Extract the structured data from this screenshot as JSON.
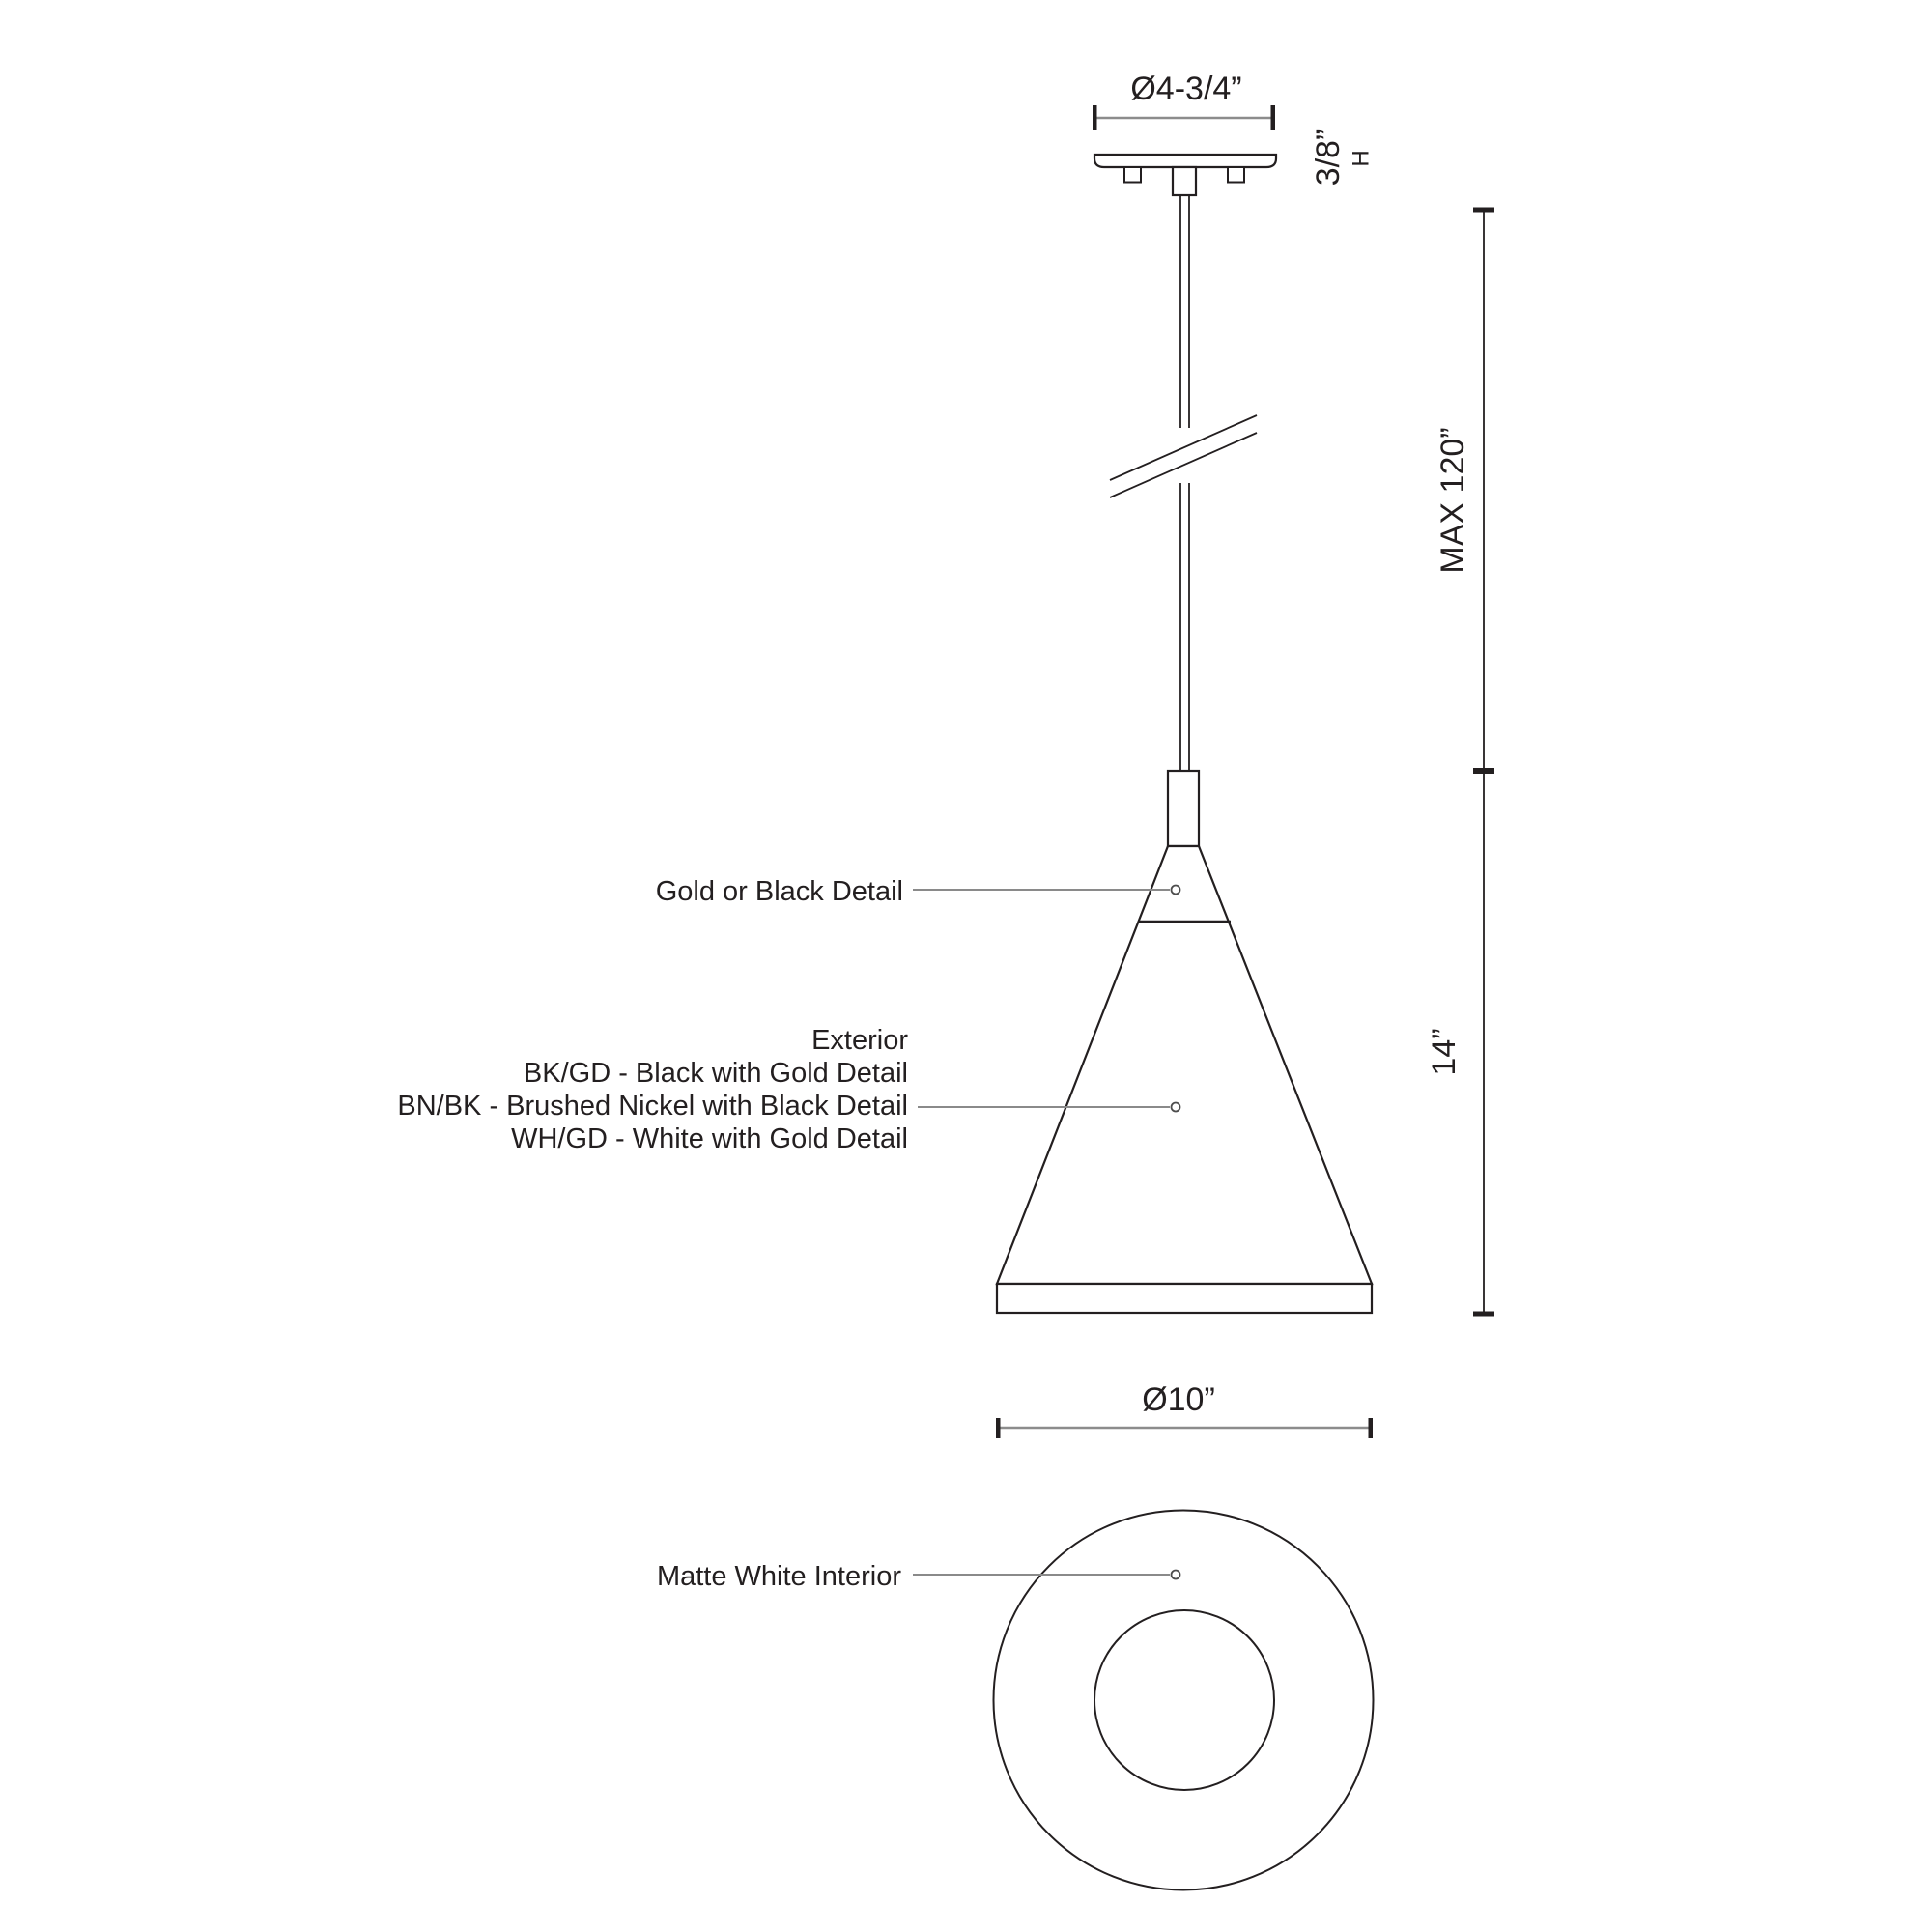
{
  "colors": {
    "ink": "#231f20",
    "dim": "#8c8c8c",
    "leader": "#8a8a8a",
    "paper": "#ffffff"
  },
  "dimensions": {
    "canopy_diameter": "Ø4-3/4”",
    "canopy_height": "3/8”",
    "canopy_height_axis": "H",
    "max_suspension": "MAX 120”",
    "shade_height": "14”",
    "shade_diameter": "Ø10”"
  },
  "labels": {
    "detail": "Gold or Black Detail",
    "exterior_title": "Exterior",
    "finish_options": [
      "BK/GD - Black with Gold Detail",
      "BN/BK - Brushed Nickel with Black Detail",
      "WH/GD - White with Gold Detail"
    ],
    "interior": "Matte White Interior"
  }
}
